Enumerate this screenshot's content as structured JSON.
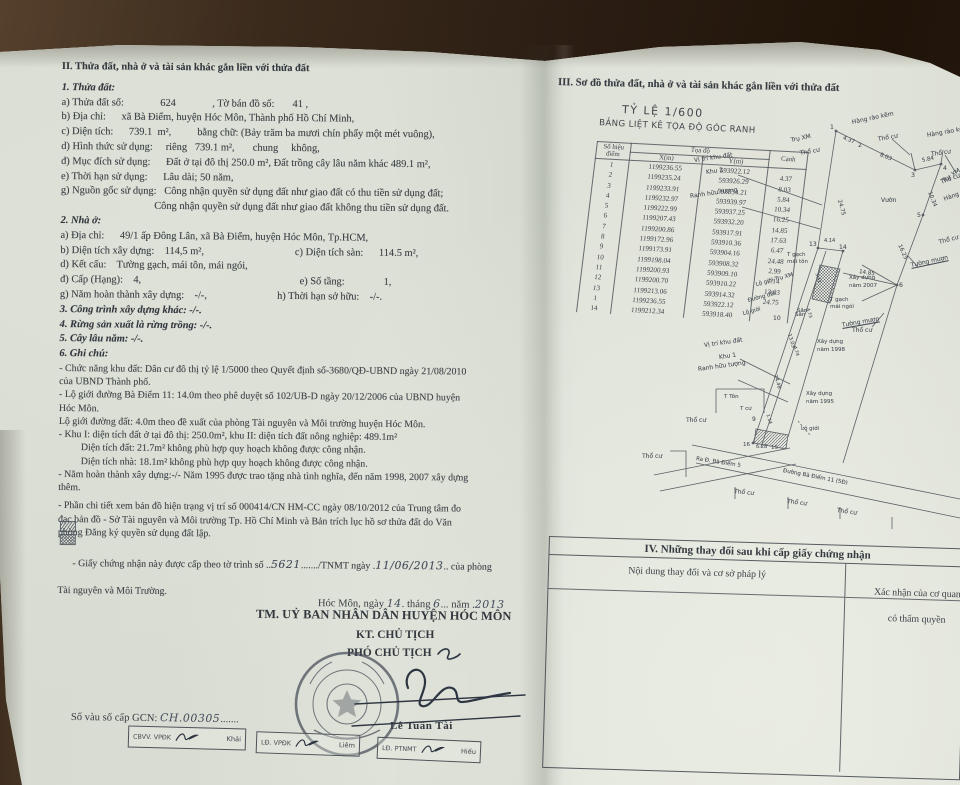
{
  "page_left": {
    "section2_title": "II. Thửa đất, nhà ở và tài sản khác gắn liền với thửa đất",
    "sub1_title": "1. Thửa đất:",
    "sub1_lines": [
      "a) Thửa đất số:              624              , Tờ bán đồ số:       41 ,",
      "b) Địa chỉ:      xã Bà Điểm, huyện Hóc Môn, Thành phố Hồ Chí Minh,",
      "c) Diện tích:      739.1  m²,          bằng chữ: (Bảy trăm ba mươi chín phẩy một mét vuông),",
      "d) Hình thức sử dụng:     riêng   739.1 m²,       chung     không,",
      "đ) Mục đích sử dụng:      Đất ở tại đô thị 250.0 m², Đất trồng cây lâu năm khác 489.1 m²,",
      "e) Thời hạn sử dụng:      Lâu dài; 50 năm,",
      "g) Nguồn gốc sử dụng:   Công nhận quyền sử dụng đất như giao đất có thu tiền sử dụng đất;",
      "                                    Công nhận quyền sử dụng đất như giao đất không thu tiền sử dụng đất."
    ],
    "sub2_title": "2. Nhà ở:",
    "sub2_lines": [
      "a) Địa chỉ:      49/1 ấp Đông Lân, xã Bà Điểm, huyện Hóc Môn, Tp.HCM,",
      "b) Diện tích xây dựng:    114,5 m²,                                   c) Diện tích sàn:      114.5 m²,",
      "d) Kết cấu:    Tường gạch, mái tôn, mái ngói,",
      "đ) Cấp (Hạng):    4,                                                             e) Số tầng:               1,",
      "g) Năm hoàn thành xây dựng:    -/-,                           h) Thời hạn sở hữu:    -/-."
    ],
    "sub3_title": "3. Công trình xây dựng khác: -/-.",
    "sub4_title": "4. Rừng sản xuất là rừng trồng: -/-.",
    "sub5_title": "5. Cây lâu năm: -/-.",
    "sub6_title": "6. Ghi chú:",
    "notes_lines": [
      "- Chức năng khu đất: Dân cư đô thị tỷ lệ 1/5000 theo Quyết định số-3680/QĐ-UBND ngày 21/08/2010",
      "của UBND Thành phố.",
      "- Lộ giới đường Bà Điểm 11: 14.0m theo phê duyệt số 102/UB-D ngày 20/12/2006 của UBND huyện",
      "Hóc Môn.",
      "Lộ giới đường đất: 4.0m theo đề xuất của phòng Tài nguyên và Môi trường huyện Hóc Môn.",
      "- Khu I: diện tích đất ở tại đô thị: 250.0m², khu II: diện tích đất nông nghiệp: 489.1m²",
      "         Diện tích đất: 21.7m² không phù hợp quy hoạch không được công nhận.",
      "         Diện tích nhà: 18.1m² không phù hợp quy hoạch không được công nhận.",
      "- Năm hoàn thành xây dựng:-/- Năm 1995 được trao tặng nhà tình nghĩa, đến năm 1998, 2007 xây dựng",
      "thêm."
    ],
    "notes2_lines": [
      "- Phần chi tiết xem bản đồ hiện trạng vị trí số 000414/CN HM-CC ngày 08/10/2012 của Trung tâm đo",
      "đạc bản đồ - Sở Tài nguyên và Môi trường Tp. Hồ Chí Minh và Bản trích lục hồ sơ thửa đất do Văn",
      "phòng Đăng ký quyền sử dụng đất lập."
    ],
    "cert_line": {
      "pre": "- Giấy chứng nhận này được cấp theo tờ trình số ..",
      "num": "5621",
      "mid": "......./TNMT ngày .",
      "date": "11/06/2013",
      "post": ".. của phòng"
    },
    "cert_line2": "Tài nguyên và Môi Trường.",
    "date_line": {
      "p1": "Hóc Môn, ngày ",
      "d": "14",
      "p2": ". tháng ",
      "m": "6",
      "p3": "... năm .",
      "y": "2013"
    },
    "authority": "TM. UỶ BAN NHÂN DÂN HUYỆN HÓC MÔN",
    "kt": "KT. CHỦ TỊCH",
    "pho": "PHÓ CHỦ TỊCH",
    "signer_name": "Lê Tuấn Tài",
    "gcn_no": {
      "label": "Số vàu số cấp GCN: ",
      "value": "CH.00305",
      "dots": "......."
    },
    "sign_boxes": [
      {
        "role": "CBVV. VPĐK",
        "name": "Khải",
        "x": 128,
        "y": 727,
        "w": 118,
        "r": 1.5
      },
      {
        "role": "LĐ. VPĐK",
        "name": "Liêm",
        "x": 256,
        "y": 733,
        "w": 104,
        "r": 2
      },
      {
        "role": "LĐ. PTNMT",
        "name": "Hiếu",
        "x": 377,
        "y": 739,
        "w": 104,
        "r": 2.5
      }
    ]
  },
  "page_right": {
    "section3_title": "III. Sơ đồ thửa đất, nhà ở và tài sản khác gắn liền với thửa đất",
    "scale_label": "TỶ LỆ 1/600",
    "table_title": "BẢNG LIỆT KÊ TỌA ĐỘ GÓC RANH",
    "table": {
      "h_point": "Số hiệu điểm",
      "h_coord": "Tọa độ",
      "h_x": "X(m)",
      "h_y": "Y(m)",
      "h_edge": "Cạnh",
      "rows": [
        [
          "1",
          "1199236.55",
          "593922.12",
          ""
        ],
        [
          "2",
          "1199235.24",
          "593926.29",
          "4.37"
        ],
        [
          "3",
          "1199233.91",
          "593934.21",
          "8.03"
        ],
        [
          "4",
          "1199232.97",
          "593939.97",
          "5.84"
        ],
        [
          "5",
          "1199222.99",
          "593937.25",
          "10.34"
        ],
        [
          "6",
          "1199207.43",
          "593932.20",
          "16.25"
        ],
        [
          "7",
          "1199200.86",
          "593917.91",
          "14.85"
        ],
        [
          "8",
          "1199172.96",
          "593910.36",
          "17.63"
        ],
        [
          "9",
          "1199173.91",
          "593904.16",
          "6.47"
        ],
        [
          "10",
          "1199198.04",
          "593908.32",
          "24.48"
        ],
        [
          "11",
          "1199200.93",
          "593909.10",
          "2.99"
        ],
        [
          "12",
          "1199200.70",
          "593910.22",
          "1.14"
        ],
        [
          "13",
          "1199213.06",
          "593914.32",
          "13.03"
        ],
        [
          "1",
          "1199236.55",
          "593922.12",
          "24.75"
        ],
        [
          "14",
          "1199212.34",
          "593918.40",
          ""
        ]
      ]
    },
    "map_labels": [
      {
        "t": "1",
        "x": 190,
        "y": 29,
        "s": 6.2
      },
      {
        "t": "4.37",
        "x": 203,
        "y": 40,
        "r": 22,
        "s": 5.5
      },
      {
        "t": "2",
        "x": 218,
        "y": 47,
        "s": 6.2
      },
      {
        "t": "8.03",
        "x": 240,
        "y": 57,
        "r": 22,
        "s": 5.5
      },
      {
        "t": "3",
        "x": 271,
        "y": 77,
        "s": 6.2
      },
      {
        "t": "5.84",
        "x": 282,
        "y": 63,
        "r": -12,
        "s": 5.5
      },
      {
        "t": "4",
        "x": 303,
        "y": 70,
        "s": 6.2
      },
      {
        "t": "Trụ XM",
        "x": 151,
        "y": 42,
        "r": -12
      },
      {
        "t": "Thổ cư",
        "x": 160,
        "y": 55,
        "r": -10
      },
      {
        "t": "Hàng rào kẽm",
        "x": 212,
        "y": 24,
        "r": -12
      },
      {
        "t": "Thổ cư",
        "x": 238,
        "y": 41,
        "r": -10
      },
      {
        "t": "Hàng rào kẽ",
        "x": 287,
        "y": 37,
        "r": -10
      },
      {
        "t": "Thổ cư",
        "x": 291,
        "y": 56,
        "r": -8
      },
      {
        "t": "Trụ XM",
        "x": 303,
        "y": 83,
        "r": -35
      },
      {
        "t": "Vị trí khu đất",
        "x": 54,
        "y": 62,
        "r": -8
      },
      {
        "t": "Khu 2",
        "x": 66,
        "y": 74,
        "r": -8
      },
      {
        "t": "Ranh hữu tượng",
        "x": 50,
        "y": 98,
        "r": -8
      },
      {
        "t": "24.75",
        "x": 199,
        "y": 102,
        "r": 75,
        "s": 5.5
      },
      {
        "t": "Vườn",
        "x": 241,
        "y": 102
      },
      {
        "t": "10.34",
        "x": 289,
        "y": 94,
        "r": 68,
        "s": 5.5
      },
      {
        "t": "Thổ cư",
        "x": 301,
        "y": 84,
        "r": -20
      },
      {
        "t": "Hàng rà",
        "x": 304,
        "y": 101,
        "r": -20
      },
      {
        "t": "5",
        "x": 277,
        "y": 117,
        "s": 6.2
      },
      {
        "t": "Thổ cư",
        "x": 299,
        "y": 144,
        "r": -15
      },
      {
        "t": "16.25",
        "x": 259,
        "y": 147,
        "r": 65,
        "s": 5.5
      },
      {
        "t": "Tường mượn",
        "x": 271,
        "y": 167,
        "r": -12,
        "u": 1
      },
      {
        "t": "6",
        "x": 259,
        "y": 187,
        "s": 6.2
      },
      {
        "t": "14.85",
        "x": 219,
        "y": 174,
        "r": 9,
        "s": 5.5
      },
      {
        "t": "Tường mượn",
        "x": 202,
        "y": 227,
        "r": -10,
        "u": 1
      },
      {
        "t": "13",
        "x": 169,
        "y": 146,
        "s": 6
      },
      {
        "t": "4.14",
        "x": 184,
        "y": 143,
        "s": 5
      },
      {
        "t": "14",
        "x": 199,
        "y": 149,
        "s": 6
      },
      {
        "t": "T gạch",
        "x": 147,
        "y": 157,
        "s": 5.5
      },
      {
        "t": "mái tôn",
        "x": 147,
        "y": 164,
        "s": 5.5
      },
      {
        "t": "Xây dựng",
        "x": 209,
        "y": 180,
        "s": 5.5
      },
      {
        "t": "năm 2007",
        "x": 209,
        "y": 188,
        "s": 5.5
      },
      {
        "t": "T gạch",
        "x": 190,
        "y": 202,
        "s": 5.5
      },
      {
        "t": "mái ngói",
        "x": 190,
        "y": 209,
        "s": 5.5
      },
      {
        "t": "Sân",
        "x": 157,
        "y": 213,
        "s": 5.5
      },
      {
        "t": "Thổ cư",
        "x": 212,
        "y": 232
      },
      {
        "t": "Xây dựng",
        "x": 177,
        "y": 244,
        "s": 5.5
      },
      {
        "t": "năm 1998",
        "x": 177,
        "y": 252,
        "s": 5.5
      },
      {
        "t": "Xây dựng",
        "x": 166,
        "y": 296,
        "s": 5.5
      },
      {
        "t": "năm 1995",
        "x": 166,
        "y": 304,
        "s": 5.5
      },
      {
        "t": "Lộ giới Trụ XM",
        "x": 116,
        "y": 187,
        "r": -15,
        "s": 5.5
      },
      {
        "t": "Đường đất",
        "x": 108,
        "y": 203,
        "r": -15,
        "s": 5.5
      },
      {
        "t": "Lộ giới",
        "x": 103,
        "y": 216,
        "r": -15,
        "s": 5.5
      },
      {
        "t": "10",
        "x": 133,
        "y": 220,
        "s": 6
      },
      {
        "t": "Sân",
        "x": 155,
        "y": 217,
        "s": 5.5
      },
      {
        "t": "3.42",
        "x": 176,
        "y": 176,
        "r": 73,
        "s": 4.5
      },
      {
        "t": "4.73",
        "x": 167,
        "y": 211,
        "r": 73,
        "s": 4.5
      },
      {
        "t": "13.03",
        "x": 149,
        "y": 236,
        "r": 73,
        "s": 5
      },
      {
        "t": "4.74",
        "x": 154,
        "y": 249,
        "r": 73,
        "s": 4.5
      },
      {
        "t": "24.48",
        "x": 135,
        "y": 277,
        "r": 73,
        "s": 5
      },
      {
        "t": "1.14",
        "x": 127,
        "y": 317,
        "r": 73,
        "s": 4.5
      },
      {
        "t": "Vị trí khu đất",
        "x": 64,
        "y": 247,
        "r": -8
      },
      {
        "t": "Khu 1",
        "x": 79,
        "y": 259,
        "r": -8
      },
      {
        "t": "Ranh hữu tượng",
        "x": 58,
        "y": 271,
        "r": -8
      },
      {
        "t": "T Tôn",
        "x": 84,
        "y": 299,
        "s": 5.5
      },
      {
        "t": "T cư",
        "x": 100,
        "y": 311,
        "s": 5.5
      },
      {
        "t": "Thổ cư",
        "x": 46,
        "y": 322
      },
      {
        "t": "9",
        "x": 112,
        "y": 321,
        "s": 6
      },
      {
        "t": "16",
        "x": 103,
        "y": 347,
        "s": 5.5
      },
      {
        "t": "6.28",
        "x": 116,
        "y": 349,
        "s": 5
      },
      {
        "t": "15",
        "x": 131,
        "y": 350,
        "s": 5.5
      },
      {
        "t": "Lộ giới",
        "x": 161,
        "y": 331,
        "s": 5.5
      },
      {
        "t": "Ra Đ. Bà Điểm 5",
        "x": 56,
        "y": 361,
        "r": 9,
        "s": 5.5
      },
      {
        "t": "Đường Bà Điểm 11 (5Đ)",
        "x": 143,
        "y": 373,
        "r": 11,
        "s": 5.5
      },
      {
        "t": "Thổ cư",
        "x": 2,
        "y": 358
      },
      {
        "t": "Thổ cư",
        "x": 94,
        "y": 393,
        "r": 6
      },
      {
        "t": "Thổ cư",
        "x": 147,
        "y": 403,
        "r": 7
      },
      {
        "t": "Thổ cư",
        "x": 197,
        "y": 412,
        "r": 8
      }
    ],
    "section4": {
      "title": "IV. Những thay đổi sau khi cấp giấy chứng nhận",
      "col1": "Nội dung thay đổi và cơ sở pháp lý",
      "col2a": "Xác nhận của cơ quan",
      "col2b": "có thẩm quyền"
    }
  }
}
